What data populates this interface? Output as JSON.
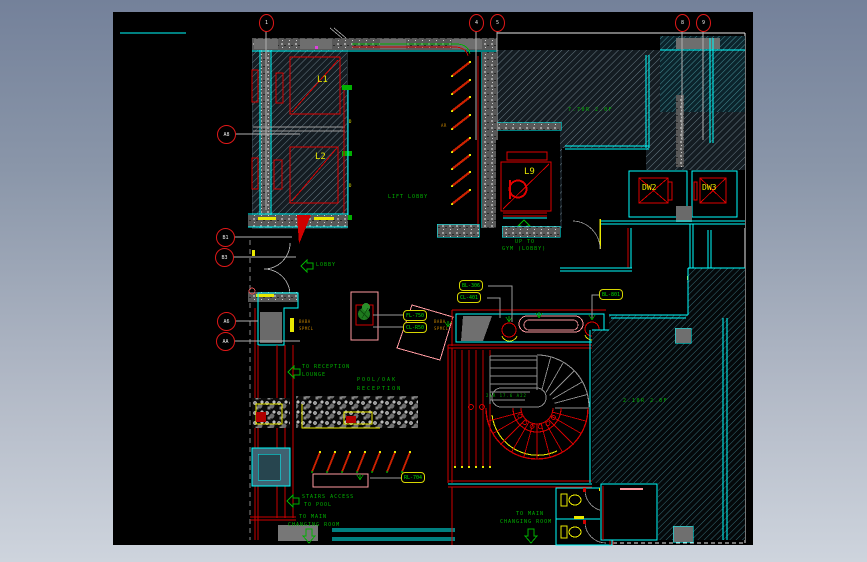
{
  "viewport": {
    "width": 867,
    "height": 562
  },
  "colors": {
    "bg_top": "#74819a",
    "bg_bottom": "#ced4dd",
    "paper": "#000000",
    "ink_cyan": "#00ffff",
    "ink_red": "#dd1111",
    "ink_yellow": "#e8e800",
    "ink_green": "#00b400",
    "ink_pink": "#ff9aa0",
    "ink_orange": "#c08000",
    "hatch_gray": "#7d929e",
    "hatch_cyan": "#4f99a6"
  },
  "grid_bubbles": {
    "top": [
      {
        "label": "1"
      },
      {
        "label": "4"
      },
      {
        "label": "5"
      },
      {
        "label": "8"
      },
      {
        "label": "9"
      }
    ],
    "left": [
      {
        "label": "A8"
      },
      {
        "label": "B1"
      },
      {
        "label": "B3"
      },
      {
        "label": "A6"
      },
      {
        "label": "AA"
      }
    ]
  },
  "equipment_labels": {
    "lift_1": "L1",
    "lift_2": "L2",
    "lift_9": "L9",
    "dumbwaiter_2": "DW2",
    "dumbwaiter_3": "DW3",
    "door_mark_1": "D",
    "door_mark_2": "D"
  },
  "finish_tags": [
    {
      "code": "BL-306"
    },
    {
      "code": "CL-401"
    },
    {
      "code": "BL-801"
    },
    {
      "code": "FL-750"
    },
    {
      "code": "CL-R50"
    },
    {
      "code": "RL-704"
    }
  ],
  "annotations": {
    "lift_lobby": "LIFT LOBBY",
    "lift_dir_line1": "UP TO",
    "lift_dir_line2": "GYM (LOBBY)",
    "lobby": "LOBBY",
    "to_reception_line1": "TO RECEPTION",
    "to_reception_line2": "LOUNGE",
    "pool_reception_line1": "POOL/OAK",
    "pool_reception_line2": "RECEPTION",
    "stairs_access_line1": "STAIRS ACCESS",
    "stairs_access_line2": "TO POOL",
    "changing_left_line1": "TO MAIN",
    "changing_left_line2": "CHANGING ROOM",
    "changing_center_line1": "TO MAIN",
    "changing_center_line2": "CHANGING ROOM",
    "upper_room_note": "7.70R 2.0F",
    "pool_deck_note": "2.10R 2.0F",
    "stair_note": "21R 17.6 A22",
    "wall_tag_line1": "BABA",
    "wall_tag_line2": "SPMCL",
    "wall_tag2_line1": "BABA",
    "wall_tag2_line2": "SPMCL",
    "ar_tag": "AR"
  }
}
